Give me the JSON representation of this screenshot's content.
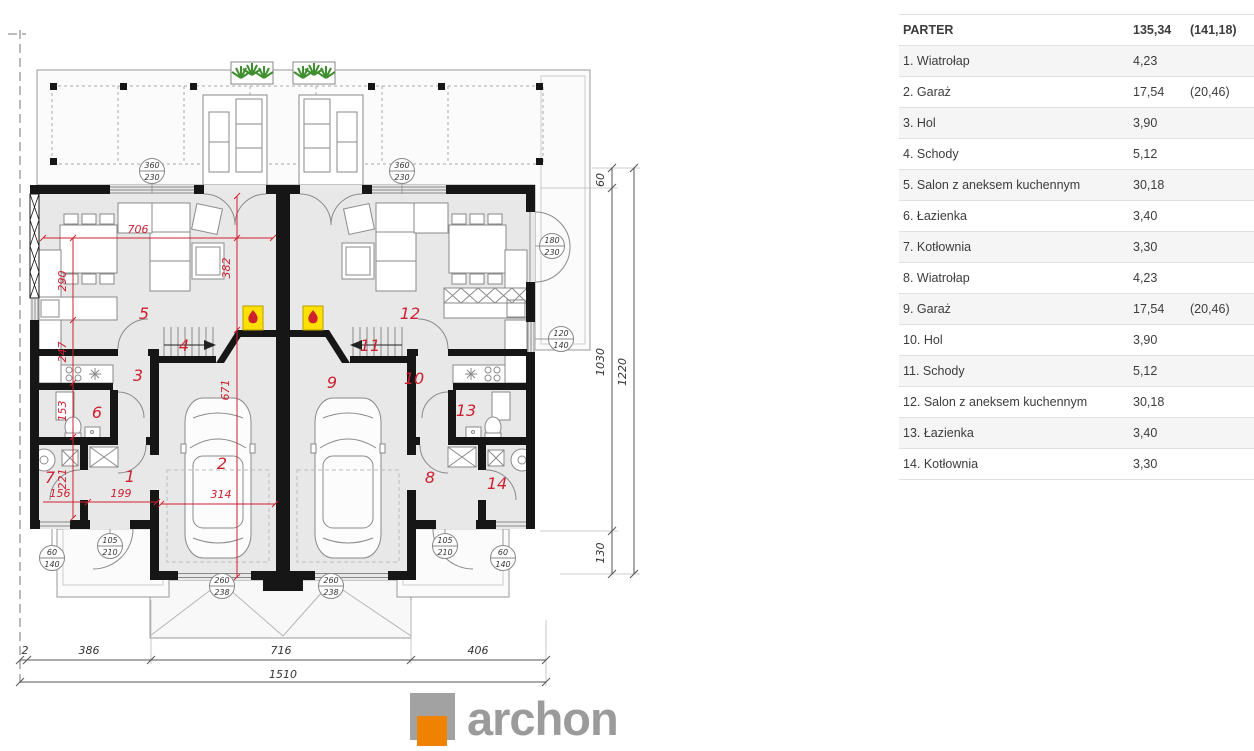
{
  "table": {
    "header": {
      "label": "PARTER",
      "area": "135,34",
      "extra": "(141,18)"
    },
    "rows": [
      {
        "label": "1. Wiatrołap",
        "area": "4,23",
        "extra": ""
      },
      {
        "label": "2. Garaż",
        "area": "17,54",
        "extra": "(20,46)"
      },
      {
        "label": "3. Hol",
        "area": "3,90",
        "extra": ""
      },
      {
        "label": "4. Schody",
        "area": "5,12",
        "extra": ""
      },
      {
        "label": "5. Salon z aneksem kuchennym",
        "area": "30,18",
        "extra": ""
      },
      {
        "label": "6. Łazienka",
        "area": "3,40",
        "extra": ""
      },
      {
        "label": "7. Kotłownia",
        "area": "3,30",
        "extra": ""
      },
      {
        "label": "8. Wiatrołap",
        "area": "4,23",
        "extra": ""
      },
      {
        "label": "9. Garaż",
        "area": "17,54",
        "extra": "(20,46)"
      },
      {
        "label": "10. Hol",
        "area": "3,90",
        "extra": ""
      },
      {
        "label": "11. Schody",
        "area": "5,12",
        "extra": ""
      },
      {
        "label": "12. Salon z aneksem kuchennym",
        "area": "30,18",
        "extra": ""
      },
      {
        "label": "13. Łazienka",
        "area": "3,40",
        "extra": ""
      },
      {
        "label": "14. Kotłownia",
        "area": "3,30",
        "extra": ""
      }
    ]
  },
  "plan": {
    "rooms": [
      "1",
      "2",
      "3",
      "4",
      "5",
      "6",
      "7",
      "8",
      "9",
      "10",
      "11",
      "12",
      "13",
      "14"
    ],
    "red_dims": [
      "706",
      "290",
      "247",
      "153",
      "221",
      "156",
      "199",
      "382",
      "671",
      "314"
    ],
    "tags": [
      {
        "a": "360",
        "b": "230"
      },
      {
        "a": "360",
        "b": "230"
      },
      {
        "a": "180",
        "b": "230"
      },
      {
        "a": "120",
        "b": "140"
      },
      {
        "a": "105",
        "b": "210"
      },
      {
        "a": "105",
        "b": "210"
      },
      {
        "a": "60",
        "b": "140"
      },
      {
        "a": "60",
        "b": "140"
      },
      {
        "a": "260",
        "b": "238"
      },
      {
        "a": "260",
        "b": "238"
      }
    ],
    "bottom_dims": {
      "offset": "2",
      "left": "386",
      "center": "716",
      "right": "406",
      "total": "1510"
    },
    "side_dims": {
      "top": "60",
      "middle": "1030",
      "bottom": "130",
      "total": "1220"
    }
  },
  "logo": {
    "text": "archon"
  },
  "colors": {
    "accent_red": "#cf2030",
    "fireplace_yellow": "#ffe000",
    "logo_orange": "#ef8200",
    "plan_fill": "#e8e8e8"
  }
}
